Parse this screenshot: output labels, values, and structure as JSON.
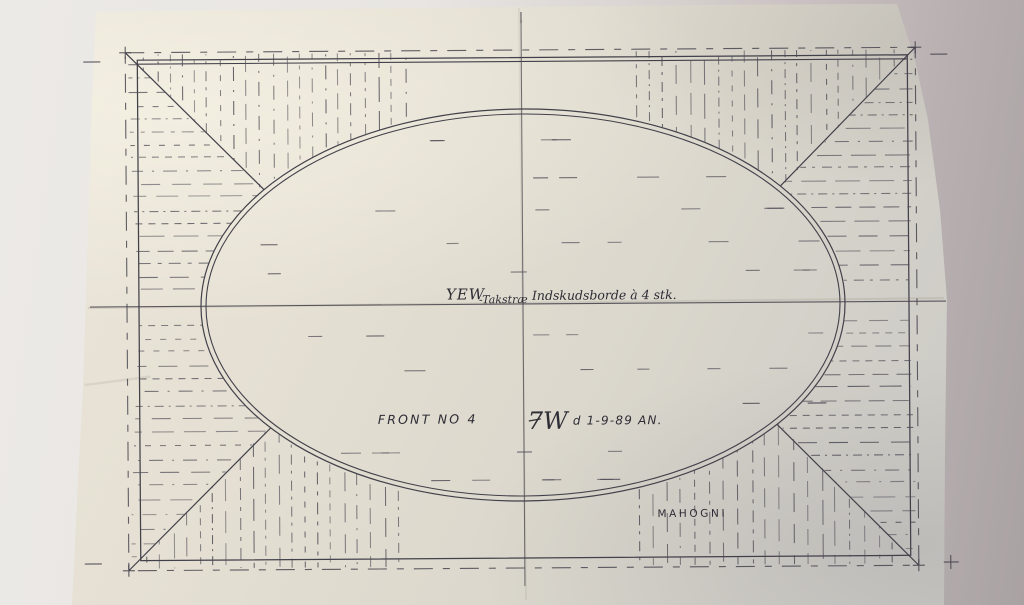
{
  "annotations": {
    "material_primary": "YEW",
    "material_primary_note": "-Takstræ",
    "insert_note": "Indskudsborde à 4 stk.",
    "view_title": "FRONT NO 4",
    "drawing_code": "7W",
    "date_note": "d 1-9-89 AN.",
    "material_secondary": "MAHOGNI"
  },
  "colors": {
    "ink": "#42404a",
    "hatch_ink": "#4c4954",
    "handwriting_ink": "#2e2c35",
    "paper": "#e4dfd2",
    "background_left": "#eceae7",
    "background_right": "#a9a2a3",
    "crease": "#8f897e"
  }
}
